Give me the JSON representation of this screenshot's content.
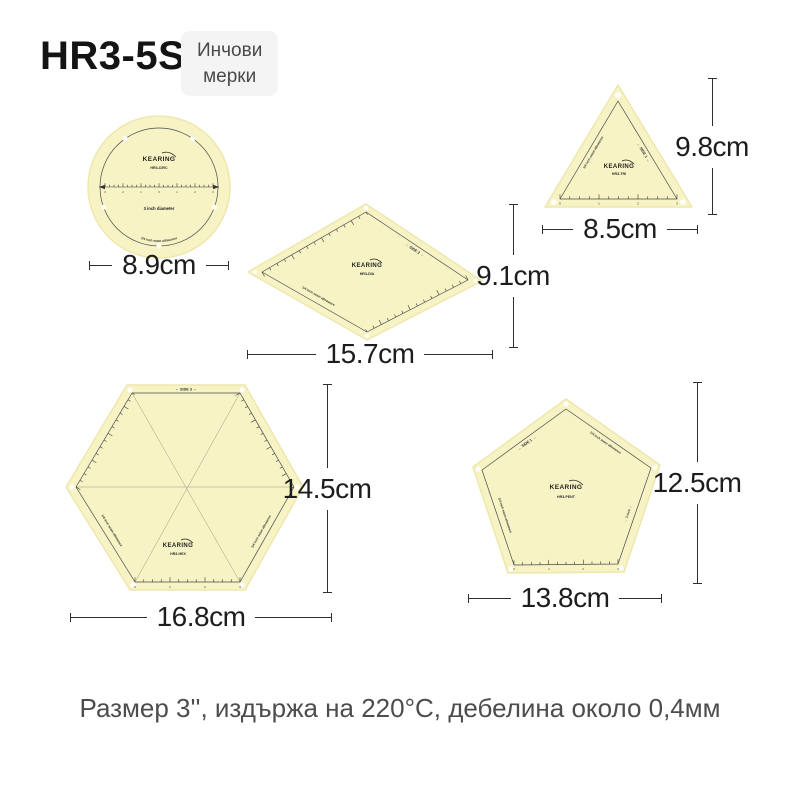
{
  "header": {
    "model": "HR3-5S",
    "badge": {
      "line1": "Инчови",
      "line2": "мерки"
    }
  },
  "brand": "KEARING",
  "caption": "Размер 3'', издържа на 220°C, дебелина около 0,4мм",
  "templates": {
    "circle": {
      "code": "HR3-CIRC",
      "diameter_label": "3 inch diameter",
      "seam_label": "1/4 inch seam allowance",
      "width_dim": "8.9cm",
      "ruler_numbers": [
        "3",
        "2",
        "1",
        "0",
        "1",
        "2",
        "3"
      ]
    },
    "triangle": {
      "code": "HR3-TRI",
      "seam_label": "1/4 inch seam allowance",
      "side_label": "←  SIDE 1  →",
      "height_dim": "9.8cm",
      "width_dim": "8.5cm",
      "ruler_numbers": [
        "0",
        "1",
        "2",
        "3"
      ]
    },
    "diamond": {
      "code": "HR3-DIA",
      "seam_label": "1/4 inch seam allowance",
      "side_label": "←  SIDE 2  →",
      "height_dim": "9.1cm",
      "width_dim": "15.7cm"
    },
    "hexagon": {
      "code": "HR3-HEX",
      "seam_label": "1/4 inch seam allowance",
      "side_label": "←  SIDE 3  →",
      "height_dim": "14.5cm",
      "width_dim": "16.8cm",
      "ruler_numbers": [
        "0",
        "1",
        "2",
        "3"
      ]
    },
    "pentagon": {
      "code": "HR3-PENT",
      "seam_label": "1/4 inch seam allowance",
      "side_label": "←  SIDE 1  →",
      "inch_label": "←  3 inch  →",
      "height_dim": "12.5cm",
      "width_dim": "13.8cm",
      "ruler_numbers": [
        "0",
        "1",
        "2",
        "3"
      ]
    }
  },
  "colors": {
    "template_fill": "#f7f3c5",
    "template_edge": "#eee7ad",
    "line": "#4a4a4a",
    "dim_line": "#2e2e2e",
    "dim_text": "#1d1d1d",
    "badge_bg": "#f4f4f4",
    "badge_text": "#4a4a4a",
    "caption_text": "#4d4d4d"
  }
}
